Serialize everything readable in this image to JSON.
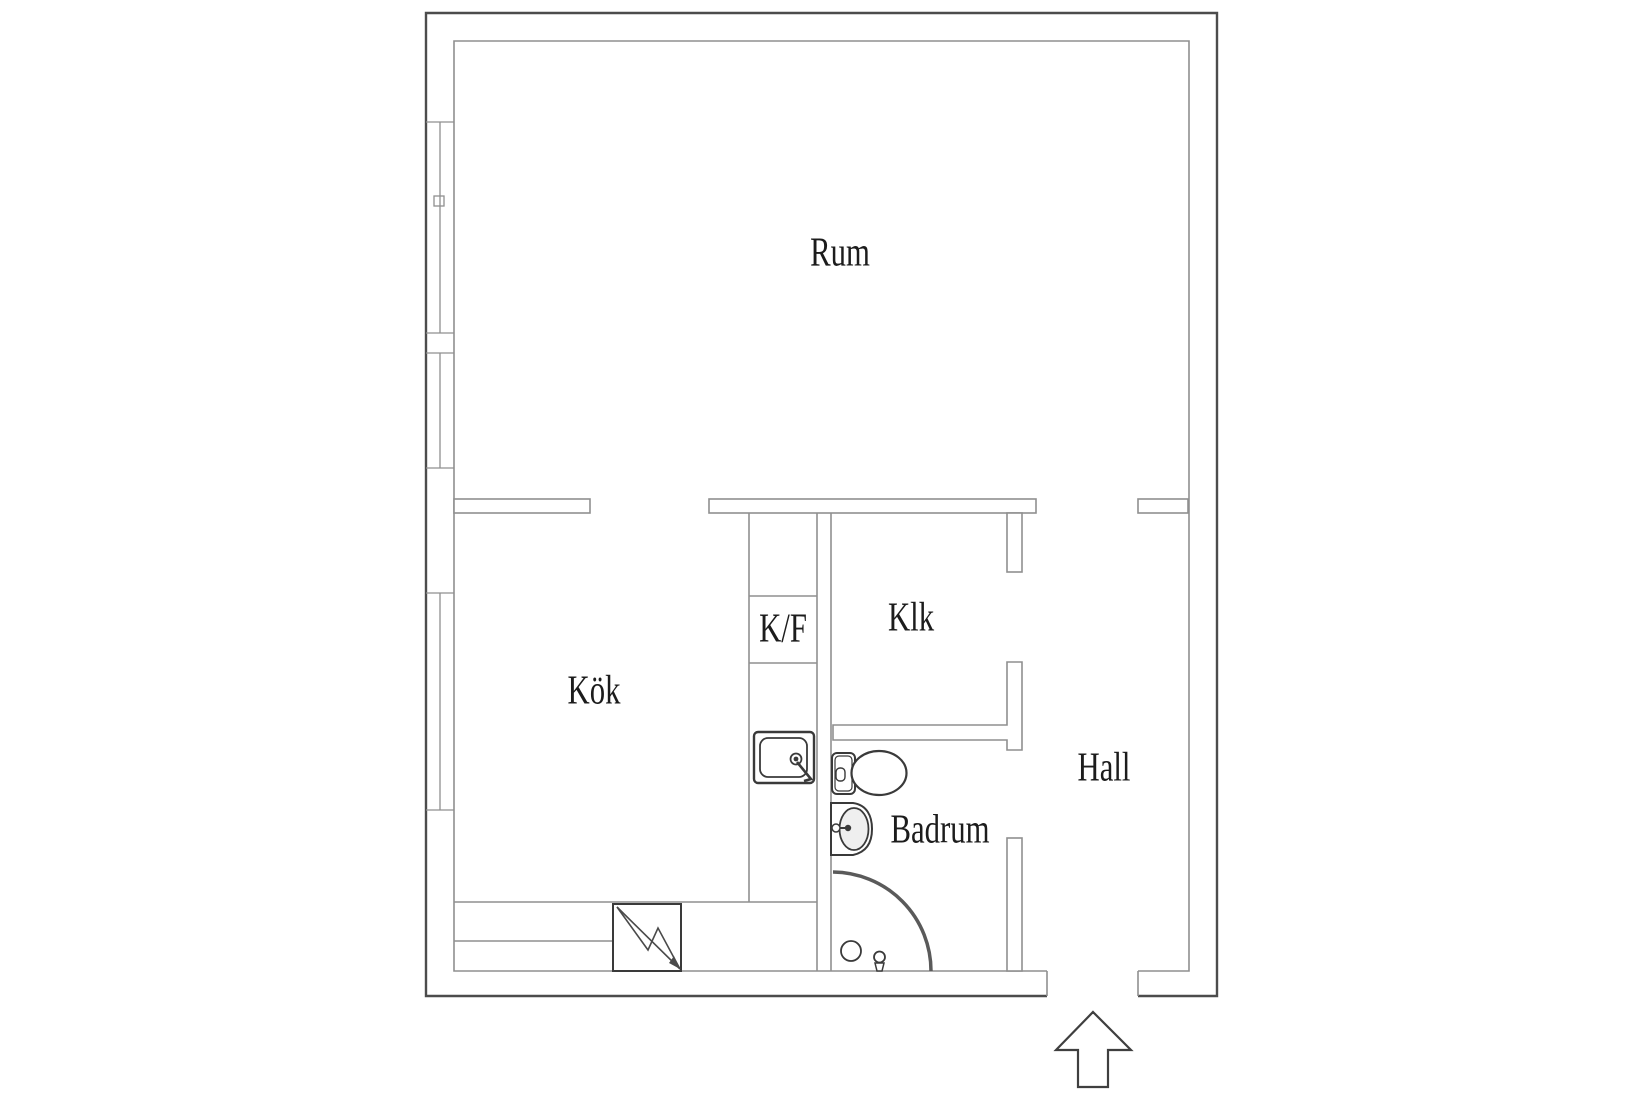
{
  "title": "Apartment floor plan",
  "rooms": [
    {
      "label": "Rum"
    },
    {
      "label": "Kök"
    },
    {
      "label": "K/F"
    },
    {
      "label": "Klk"
    },
    {
      "label": "Hall"
    },
    {
      "label": "Badrum"
    }
  ],
  "icons": {
    "entrance": "arrow-up-icon",
    "electrical_panel": "lightning-bolt-icon",
    "kitchen_sink": "kitchen-sink-icon",
    "toilet": "toilet-icon",
    "washbasin": "washbasin-icon",
    "shower": "shower-arc-icon",
    "floor_drain": "drain-circle-icon",
    "window_latch": "window-latch-icon"
  },
  "colors": {
    "background": "#ffffff",
    "outer_wall": "#4c4c4c",
    "inner_wall": "#8f8f8f",
    "fixture": "#3a3a3a",
    "shower_arc": "#5a5a5a",
    "text": "#1c1c1c"
  }
}
